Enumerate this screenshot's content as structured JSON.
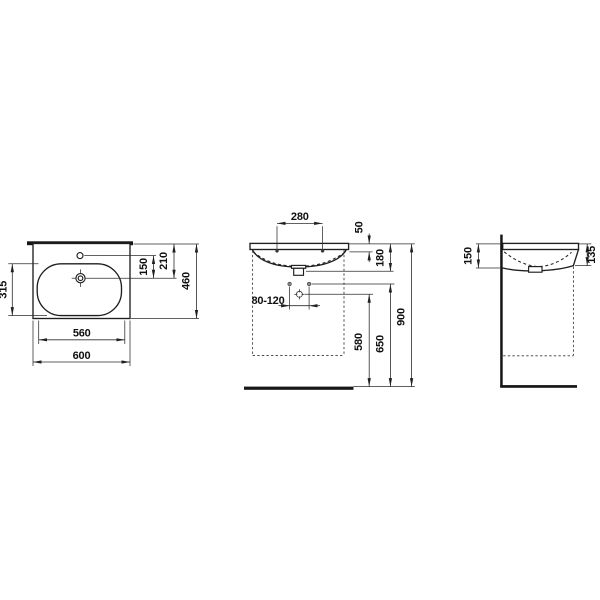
{
  "page": {
    "background": "#ffffff"
  },
  "drawing": {
    "kind": "technical-dimension-drawing",
    "subject": "wall-mounted washbasin, three orthographic views",
    "colors": {
      "line": "#1f1f1f",
      "dimension_line": "#2d2d2d",
      "text": "#101010",
      "solid_fill": "#161616",
      "background": "#ffffff"
    },
    "plan_view": {
      "dims": {
        "basin_inner_depth": "315",
        "taphole_to_drain": "150",
        "back_to_drain": "210",
        "overall_depth": "460",
        "inner_width": "560",
        "overall_width": "600"
      }
    },
    "front_view": {
      "dims": {
        "fixing_hole_spacing": "280",
        "rim_to_fixing": "50",
        "rim_to_outlet": "180",
        "supply_spacing": "80-120",
        "tap_supply_height": "580",
        "supply_height": "650",
        "rim_height": "900"
      }
    },
    "side_view": {
      "dims": {
        "back_edge_height": "150",
        "front_edge_height": "135"
      }
    }
  }
}
